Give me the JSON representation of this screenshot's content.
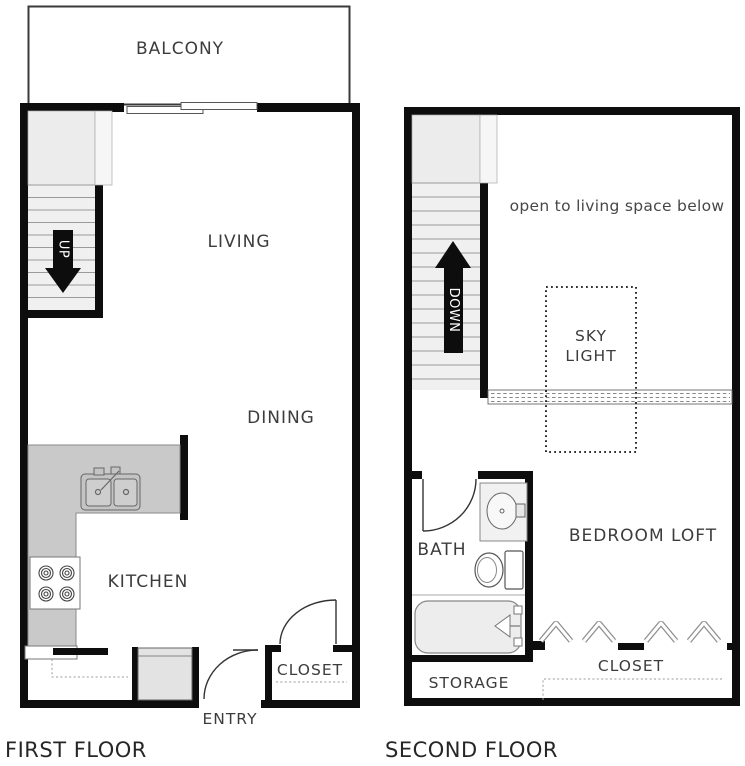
{
  "first_floor": {
    "title": "FIRST FLOOR",
    "balcony_label": "BALCONY",
    "living_label": "LIVING",
    "dining_label": "DINING",
    "kitchen_label": "KITCHEN",
    "closet_label": "CLOSET",
    "entry_label": "ENTRY",
    "stair_direction": "UP"
  },
  "second_floor": {
    "title": "SECOND FLOOR",
    "open_note": "open to living space below",
    "skylight_label_line1": "SKY",
    "skylight_label_line2": "LIGHT",
    "bath_label": "BATH",
    "bedroom_label": "BEDROOM LOFT",
    "closet_label": "CLOSET",
    "storage_label": "STORAGE",
    "stair_direction": "DOWN"
  },
  "colors": {
    "wall": "#0d0d0d",
    "counter_gray": "#c9c9c9",
    "fixture_gray": "#e3e3e3",
    "stair_fill": "#f0f0f0",
    "label_text": "#3c3c3c",
    "background": "#ffffff"
  }
}
